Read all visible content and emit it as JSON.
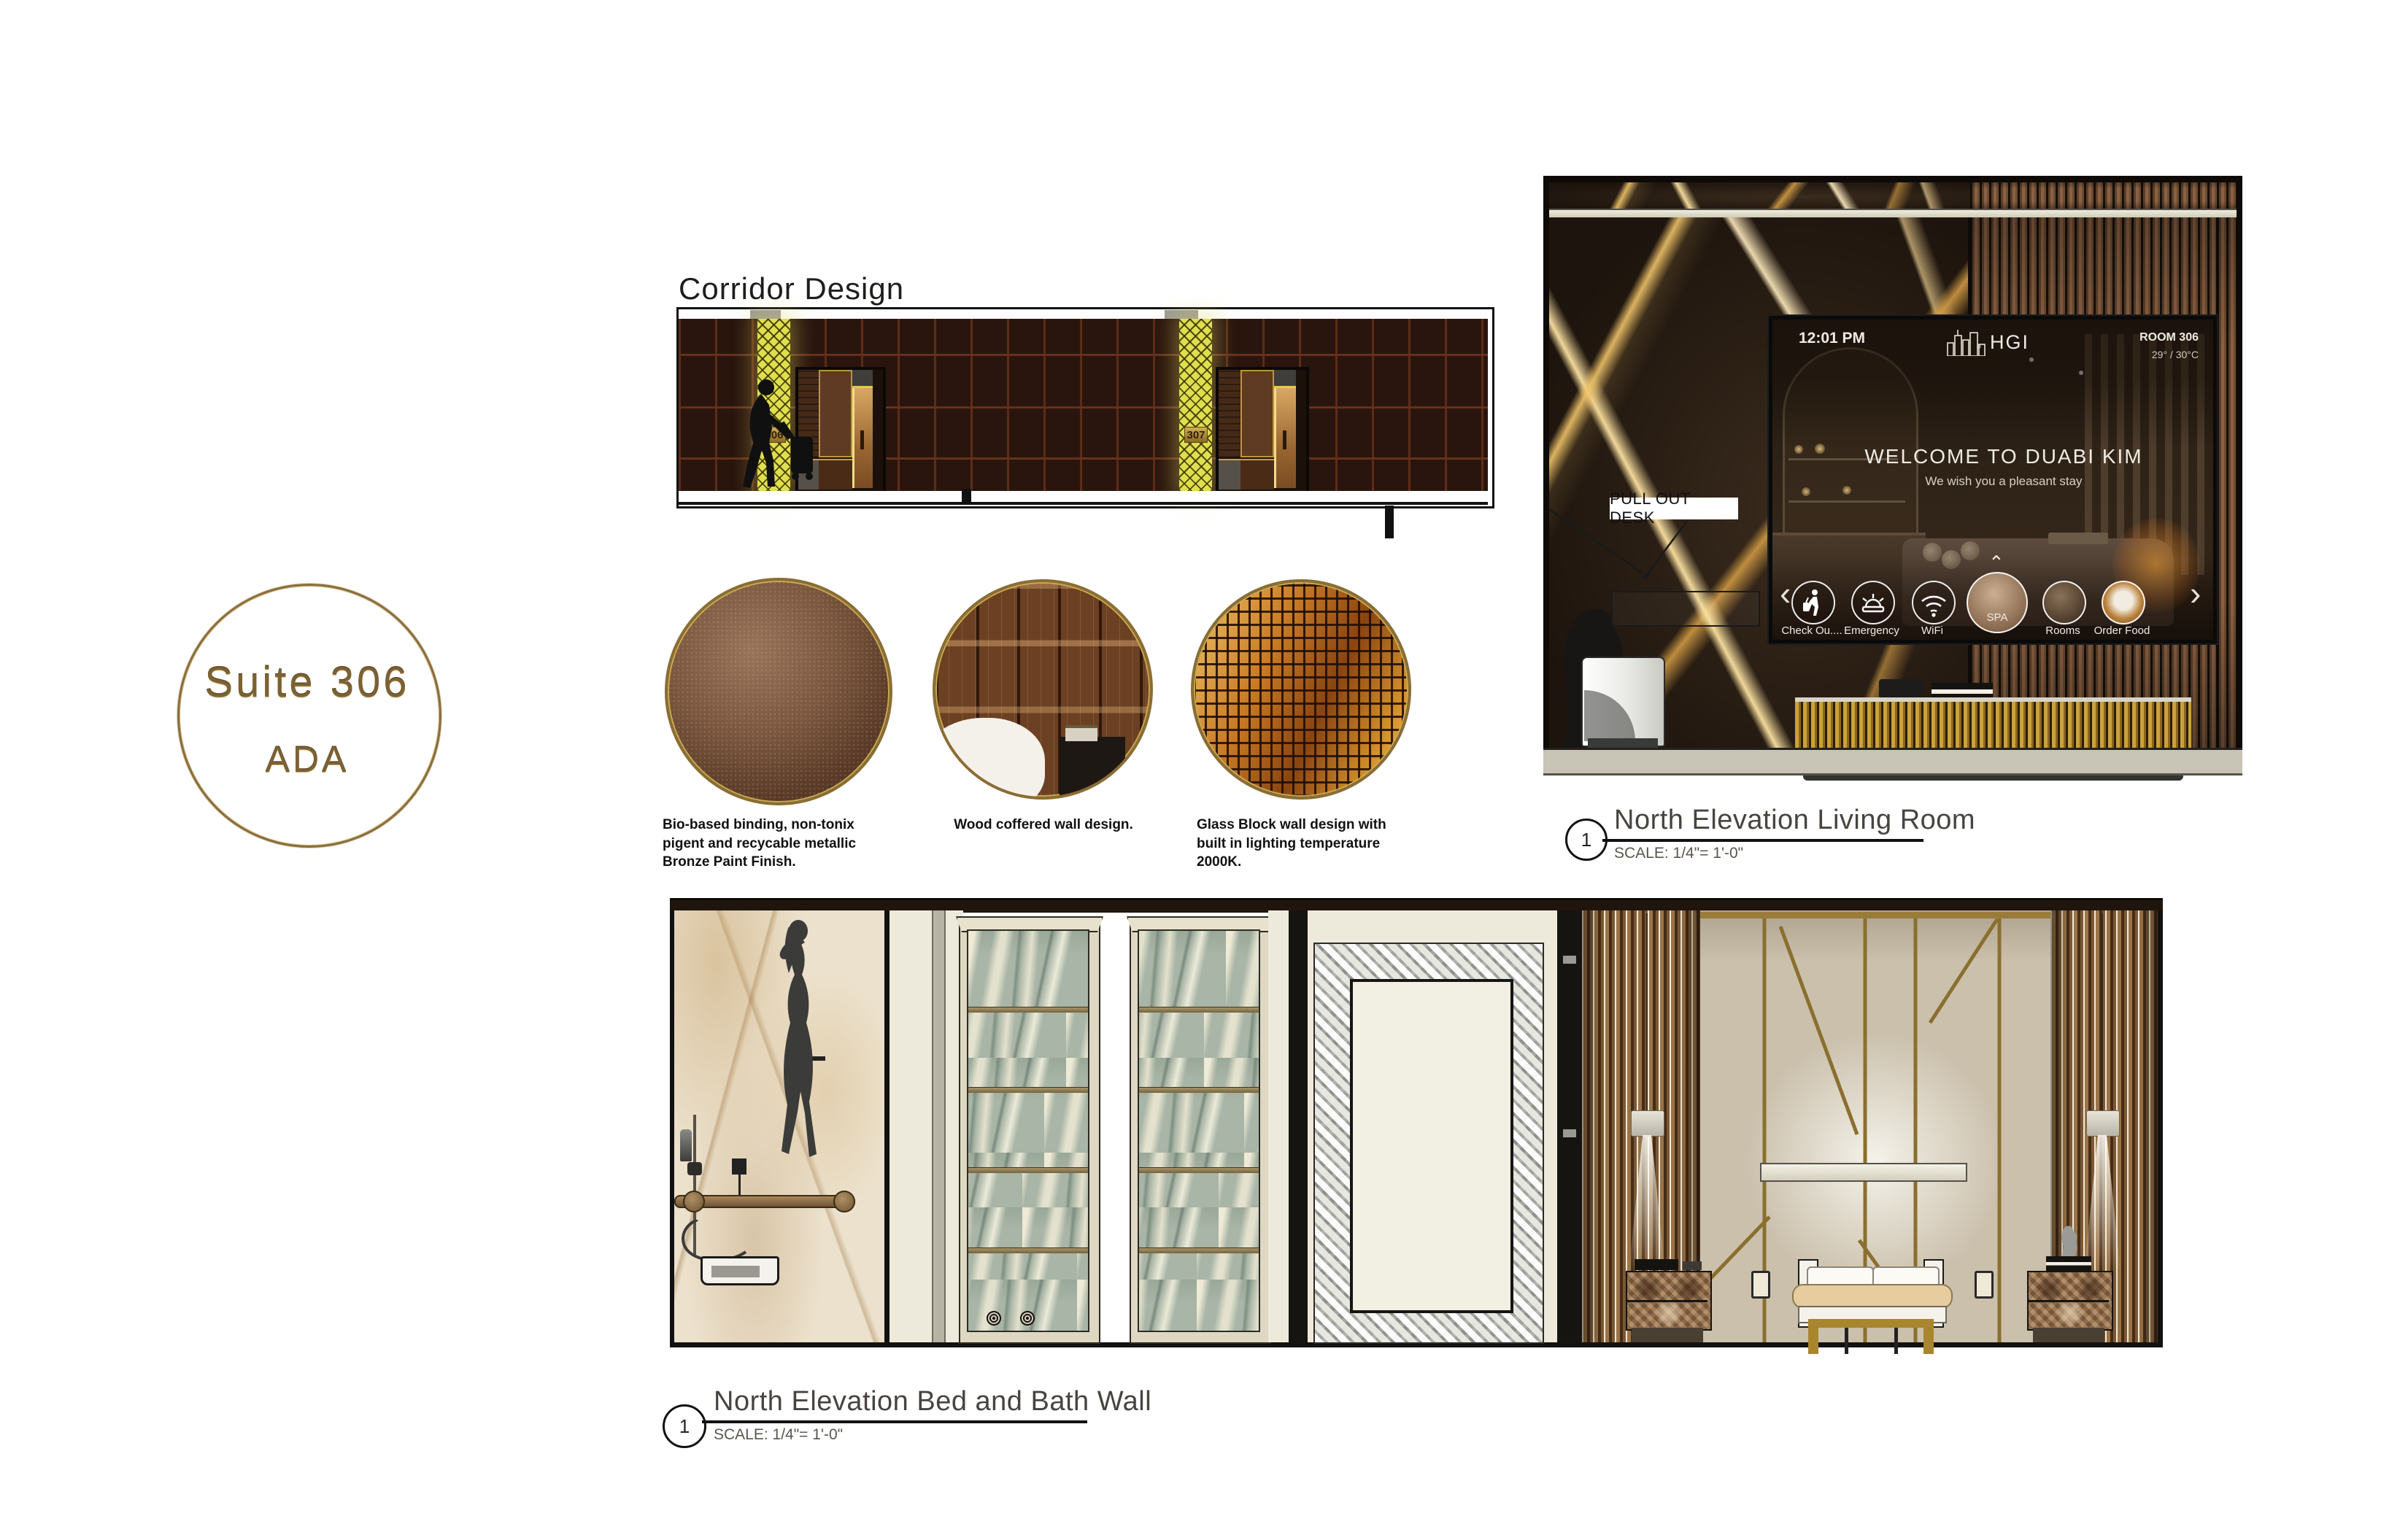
{
  "logo": {
    "line1": "Suite 306",
    "line2": "ADA"
  },
  "corridor": {
    "title": "Corridor Design",
    "door1_number": "306",
    "door2_number": "307"
  },
  "materials": {
    "swatch1_caption": "Bio-based binding, non-tonix pigent and recycable metallic Bronze Paint Finish.",
    "swatch2_caption": "Wood coffered wall design.",
    "swatch3_caption": "Glass Block wall design with built in lighting temperature 2000K."
  },
  "living_room": {
    "callout": "PULL OUT DESK",
    "tv": {
      "time": "12:01 PM",
      "brand": "HGI",
      "room": "ROOM 306",
      "temperature": "29° / 30°C",
      "headline": "WELCOME TO DUABI KIM",
      "subheadline": "We wish you a pleasant stay",
      "prev": "‹",
      "next": "›",
      "spa_up": "⌃",
      "spa_down": "⌄",
      "menu": [
        {
          "label": "Check Ou...."
        },
        {
          "label": "Emergency"
        },
        {
          "label": "WiFi"
        },
        {
          "label": "SPA"
        },
        {
          "label": "Rooms"
        },
        {
          "label": "Order Food"
        }
      ]
    },
    "drawing_number": "1",
    "title": "North Elevation Living Room",
    "scale": "SCALE: 1/4\"= 1'-0\""
  },
  "bed_bath": {
    "drawing_number": "1",
    "title": "North Elevation Bed and Bath Wall",
    "scale": "SCALE: 1/4\"= 1'-0\""
  },
  "colors": {
    "accent_gold": "#8a6d3b",
    "corridor_yellow": "#dde04c",
    "corridor_wall": "#2a150e",
    "marble_dark": "#2a2016",
    "green_marble": "#a9b5a6",
    "baseboard": "#c8c4b6"
  }
}
